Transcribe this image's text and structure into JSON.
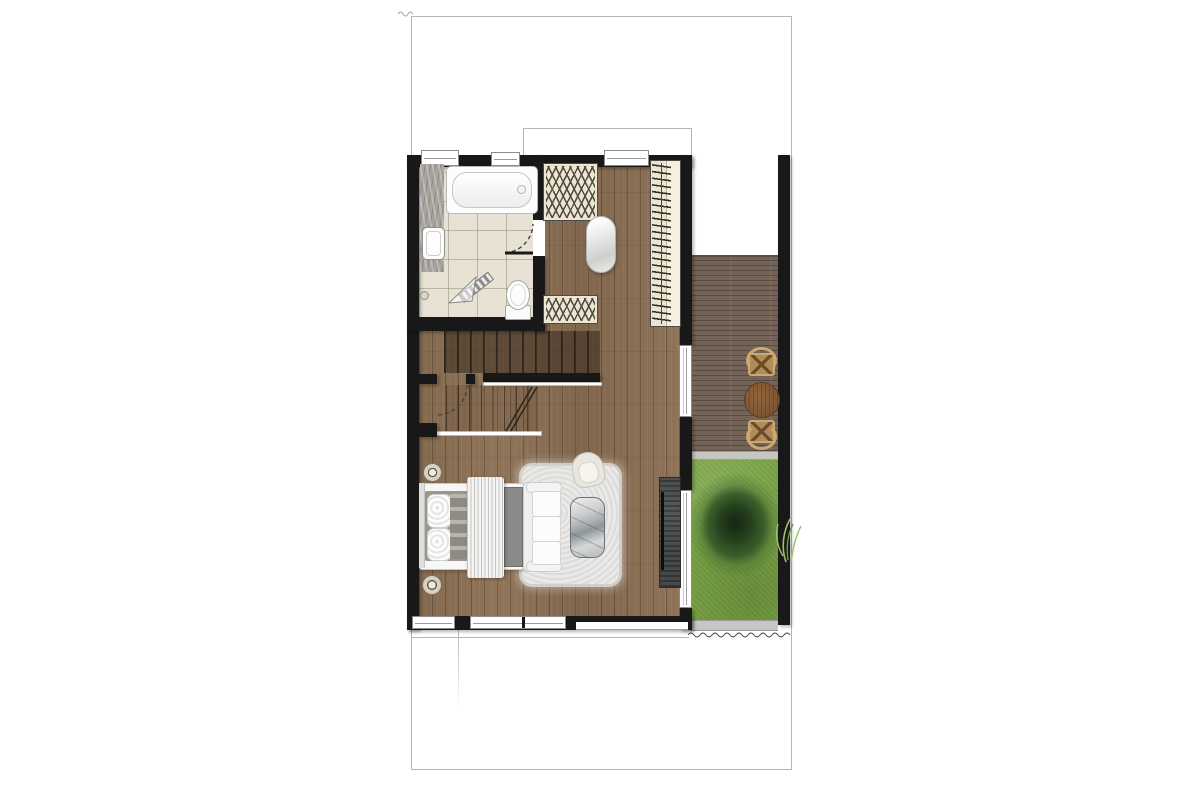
{
  "meta": {
    "description": "Architectural floor plan, top view: upper storey of a townhouse with bathroom, dressing area, walk-in closet, U-shaped staircase, combined bedroom and lounge, wooden deck with outdoor table and two chairs, and a lawn garden with a tree, all inside a rectangular property boundary."
  },
  "colors": {
    "lot-line": "#b5b5b5",
    "wall": "#181818",
    "wood": "#8b6f53",
    "tile": "#e7e2d4",
    "tile-line": "rgba(150,142,118,0.55)",
    "beige": "#ece5d0",
    "hanger": "#35302a",
    "deck": "#746357",
    "grass": "#7aa544",
    "tree": "#24401d",
    "stone": "#a6a29c",
    "edge": "#c6c6c2",
    "fixture-white": "#fdfdfd",
    "rug": "#e9e9e7",
    "console": "#45494b",
    "table-wood": "#7c5533",
    "chair-wood": "#c9aa70",
    "bench": "#8a8a88",
    "pillow-gray": "#9a9690"
  },
  "areas": [
    {
      "name": "bathroom"
    },
    {
      "name": "dressing-area"
    },
    {
      "name": "walk-in-closet"
    },
    {
      "name": "stair-hall"
    },
    {
      "name": "bedroom-lounge"
    },
    {
      "name": "wooden-deck"
    },
    {
      "name": "garden-lawn"
    }
  ],
  "fixtures": [
    {
      "name": "bathtub"
    },
    {
      "name": "vanity-sink"
    },
    {
      "name": "shower-door"
    },
    {
      "name": "toilet"
    },
    {
      "name": "wardrobe-upper"
    },
    {
      "name": "wardrobe-lower"
    },
    {
      "name": "closet-hanger-rail"
    },
    {
      "name": "daybed"
    },
    {
      "name": "staircase"
    },
    {
      "name": "double-bed"
    },
    {
      "name": "bedside-stools"
    },
    {
      "name": "foot-bench"
    },
    {
      "name": "sofa"
    },
    {
      "name": "armchair"
    },
    {
      "name": "coffee-table"
    },
    {
      "name": "shag-rug"
    },
    {
      "name": "tv-console"
    },
    {
      "name": "outdoor-round-table"
    },
    {
      "name": "outdoor-chairs"
    },
    {
      "name": "garden-tree"
    },
    {
      "name": "border-plant"
    }
  ]
}
